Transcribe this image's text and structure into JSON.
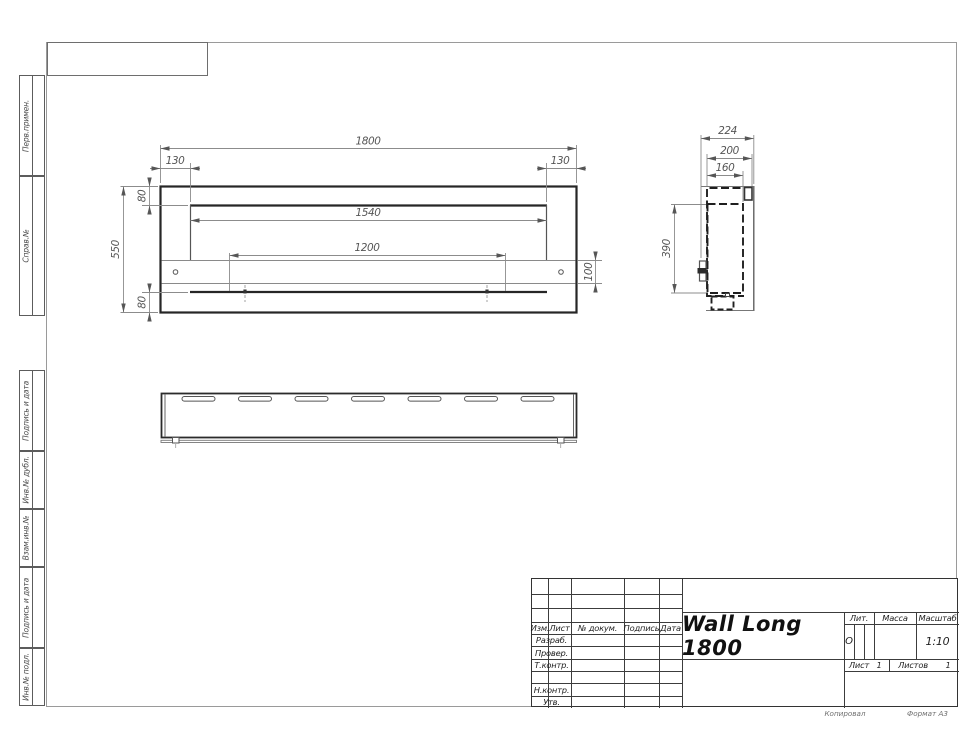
{
  "margin_labels": [
    "Перв.примен.",
    "Справ.№",
    "Подпись и дата",
    "Инв.№ дубл.",
    "Взам.инв.№",
    "Подпись и дата",
    "Инв.№ подл."
  ],
  "dims": {
    "front_overall_width": "1800",
    "front_offset_left": "130",
    "front_offset_right": "130",
    "front_opening_width": "1540",
    "front_burner_length": "1200",
    "front_overall_height": "550",
    "front_top_margin": "80",
    "front_bottom_margin": "80",
    "front_shelf_height": "100",
    "side_depth_overall": "224",
    "side_depth_case": "200",
    "side_depth_inner": "160",
    "side_inner_height": "390"
  },
  "title_block": {
    "product_name": "Wall Long 1800",
    "col_izm": "Изм.",
    "col_list": "Лист",
    "col_doc": "№ докум.",
    "col_sign": "Подпись",
    "col_date": "Дата",
    "row_developed": "Разраб.",
    "row_checked": "Провер.",
    "row_tcontrol": "Т.контр.",
    "row_ncontrol": "Н.контр.",
    "row_approved": "Утв.",
    "lit_label": "Лит.",
    "lit_value": "О",
    "mass_label": "Масса",
    "scale_label": "Масштаб",
    "scale_value": "1:10",
    "sheet_label": "Лист",
    "sheet_value": "1",
    "sheets_label": "Листов",
    "sheets_value": "1"
  },
  "notes": {
    "copied_by": "Копировал",
    "format": "Формат А3"
  }
}
